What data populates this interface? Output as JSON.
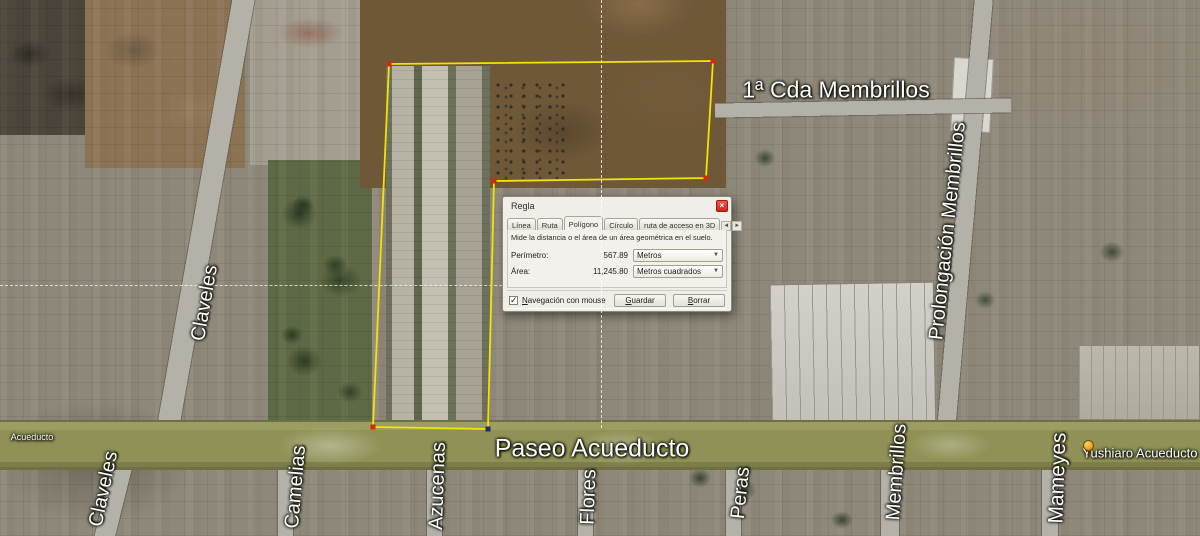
{
  "dialog": {
    "title": "Regla",
    "tabs": [
      {
        "label": "Línea",
        "active": false
      },
      {
        "label": "Ruta",
        "active": false
      },
      {
        "label": "Polígono",
        "active": true
      },
      {
        "label": "Círculo",
        "active": false
      },
      {
        "label": "ruta de acceso en 3D",
        "active": false
      }
    ],
    "description": "Mide la distancia o el área de un área geométrica en el suelo.",
    "perimeter": {
      "label": "Perímetro:",
      "value": "567.89",
      "unit": "Metros"
    },
    "area": {
      "label": "Área:",
      "value": "11,245.80",
      "unit": "Metros cuadrados"
    },
    "mouse_nav": {
      "mnemonic": "N",
      "rest": "avegación con mouse",
      "checked": true
    },
    "save_button": {
      "mnemonic": "G",
      "rest": "uardar"
    },
    "clear_button": {
      "mnemonic": "B",
      "rest": "orrar"
    }
  },
  "icons": {
    "close": "×",
    "dropdown": "▼",
    "check": "✓",
    "tab_prev": "◄",
    "tab_next": "►",
    "placemark_pin": "yellow-pushpin"
  },
  "map_labels": {
    "paseo_acueducto": "Paseo Acueducto",
    "acueducto_small": "Acueducto",
    "cda_membrillos": "1ª Cda Membrillos",
    "claveles_upper": "Claveles",
    "claveles_lower": "Claveles",
    "camelias": "Camelias",
    "azucenas": "Azucenas",
    "flores": "Flores",
    "peras": "Peras",
    "membrillos": "Membrillos",
    "mameyes": "Mameyes",
    "prolongacion_membrillos": "Prolongación Membrillos",
    "placemark": "Yushiaro Acueducto"
  },
  "measurement": {
    "tool": "Polígono",
    "perimeter_m": "567.89",
    "area_m2": "11,245.80",
    "polygon_points": [
      [
        389,
        64
      ],
      [
        713,
        61
      ],
      [
        706,
        178
      ],
      [
        494,
        181
      ],
      [
        488,
        429
      ],
      [
        373,
        427
      ]
    ],
    "last_vertex_index": 4
  },
  "colors": {
    "polygon_stroke": "#f2e400",
    "vertex": "#d42b00",
    "vertex_last": "#1d2f63",
    "close_button": "#e23b2e",
    "avenue": "#8f9156",
    "label_text": "#fdfdf8"
  }
}
